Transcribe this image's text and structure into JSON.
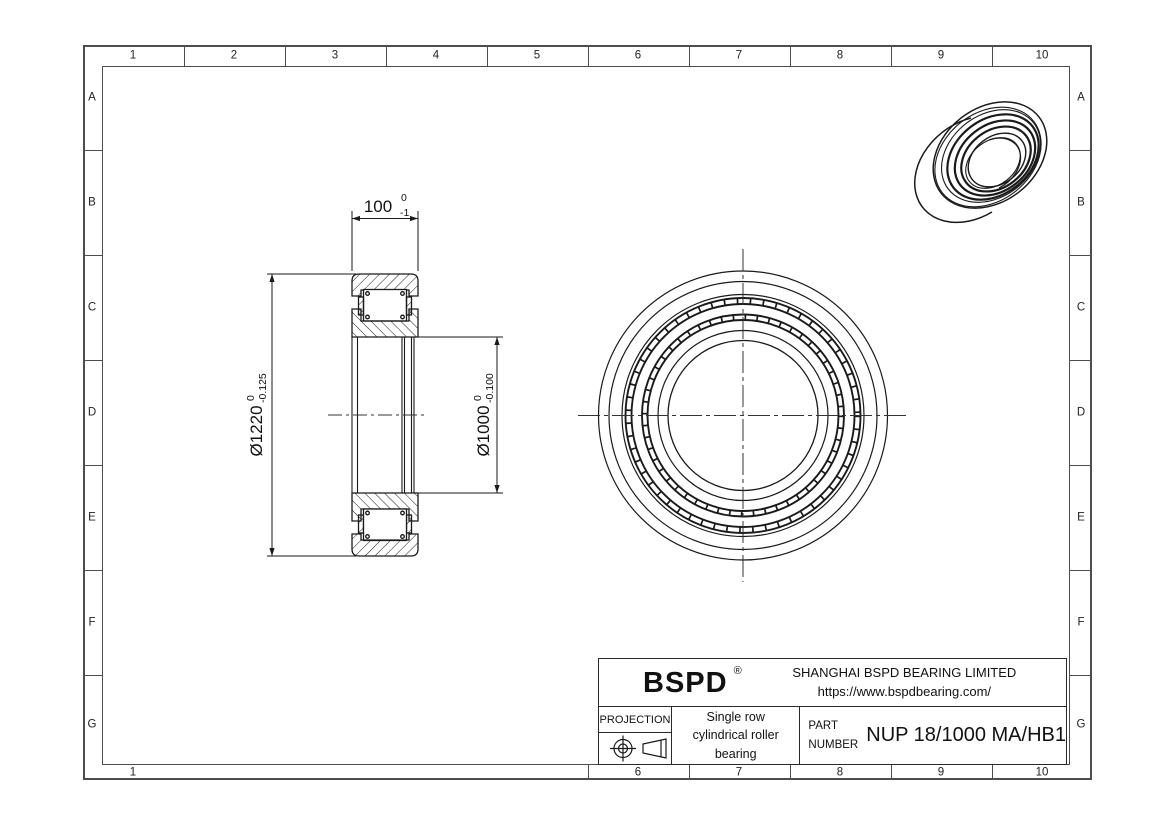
{
  "sheet": {
    "grid": {
      "columns": [
        "1",
        "2",
        "3",
        "4",
        "5",
        "6",
        "7",
        "8",
        "9",
        "10"
      ],
      "rows": [
        "A",
        "B",
        "C",
        "D",
        "E",
        "F",
        "G"
      ],
      "bottom_labels": [
        "1",
        "6",
        "7",
        "8",
        "9",
        "10"
      ]
    }
  },
  "dimensions": {
    "width": {
      "value": "100",
      "tol_upper": "0",
      "tol_lower": "-1"
    },
    "outer_diameter": {
      "value": "Ø1220",
      "tol_upper": "0",
      "tol_lower": "-0.125"
    },
    "bore_diameter": {
      "value": "Ø1000",
      "tol_upper": "0",
      "tol_lower": "-0.100"
    }
  },
  "title_block": {
    "brand": "BSPD",
    "registered_mark": "®",
    "company": "SHANGHAI BSPD BEARING LIMITED",
    "website": "https://www.bspdbearing.com/",
    "projection_label": "PROJECTION",
    "description_line1": "Single row",
    "description_line2": "cylindrical roller bearing",
    "part_label_line1": "PART",
    "part_label_line2": "NUMBER",
    "part_number": "NUP 18/1000 MA/HB1"
  },
  "colors": {
    "background": "#ffffff",
    "drawing_line": "#1a1a1a",
    "frame_line": "#4d4d4d"
  }
}
